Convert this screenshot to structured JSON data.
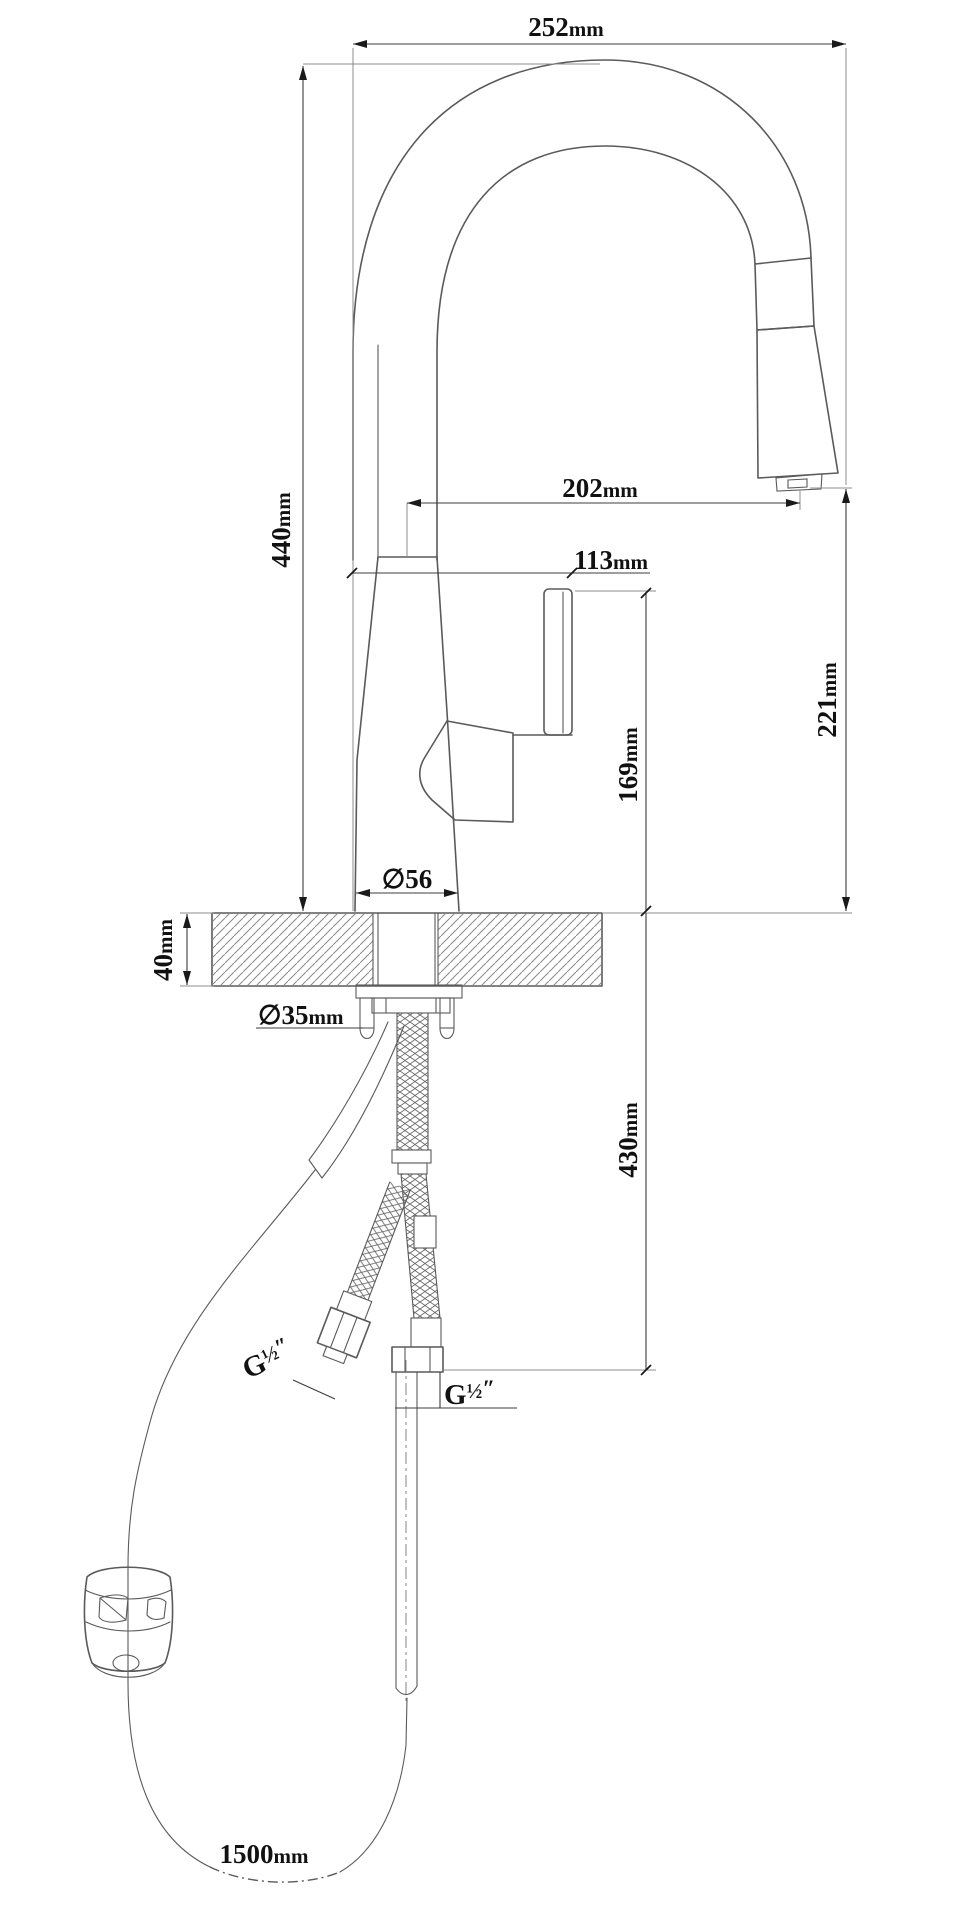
{
  "meta": {
    "type": "technical-dimension-drawing",
    "subject": "pull-down kitchen faucet with counter cross-section, supply hoses and hose weight",
    "background": "#ffffff",
    "object_line_color": "#5a5a5a",
    "dimension_color": "#1a1a1a"
  },
  "dims": {
    "overall_width": {
      "value": "252",
      "unit": "mm"
    },
    "overall_height": {
      "value": "440",
      "unit": "mm"
    },
    "spout_reach": {
      "value": "202",
      "unit": "mm"
    },
    "handle_offset": {
      "value": "113",
      "unit": "mm"
    },
    "spout_height": {
      "value": "221",
      "unit": "mm"
    },
    "handle_height": {
      "value": "169",
      "unit": "mm"
    },
    "hose_drop": {
      "value": "430",
      "unit": "mm"
    },
    "base_diameter": {
      "value": "∅56",
      "unit": ""
    },
    "counter_thickness": {
      "value": "40",
      "unit": "mm"
    },
    "hole_diameter": {
      "value": "∅35",
      "unit": "mm"
    },
    "hose_length": {
      "value": "1500",
      "unit": "mm"
    },
    "thread_size": {
      "prefix": "G",
      "fraction": "½",
      "suffix": "″"
    }
  }
}
